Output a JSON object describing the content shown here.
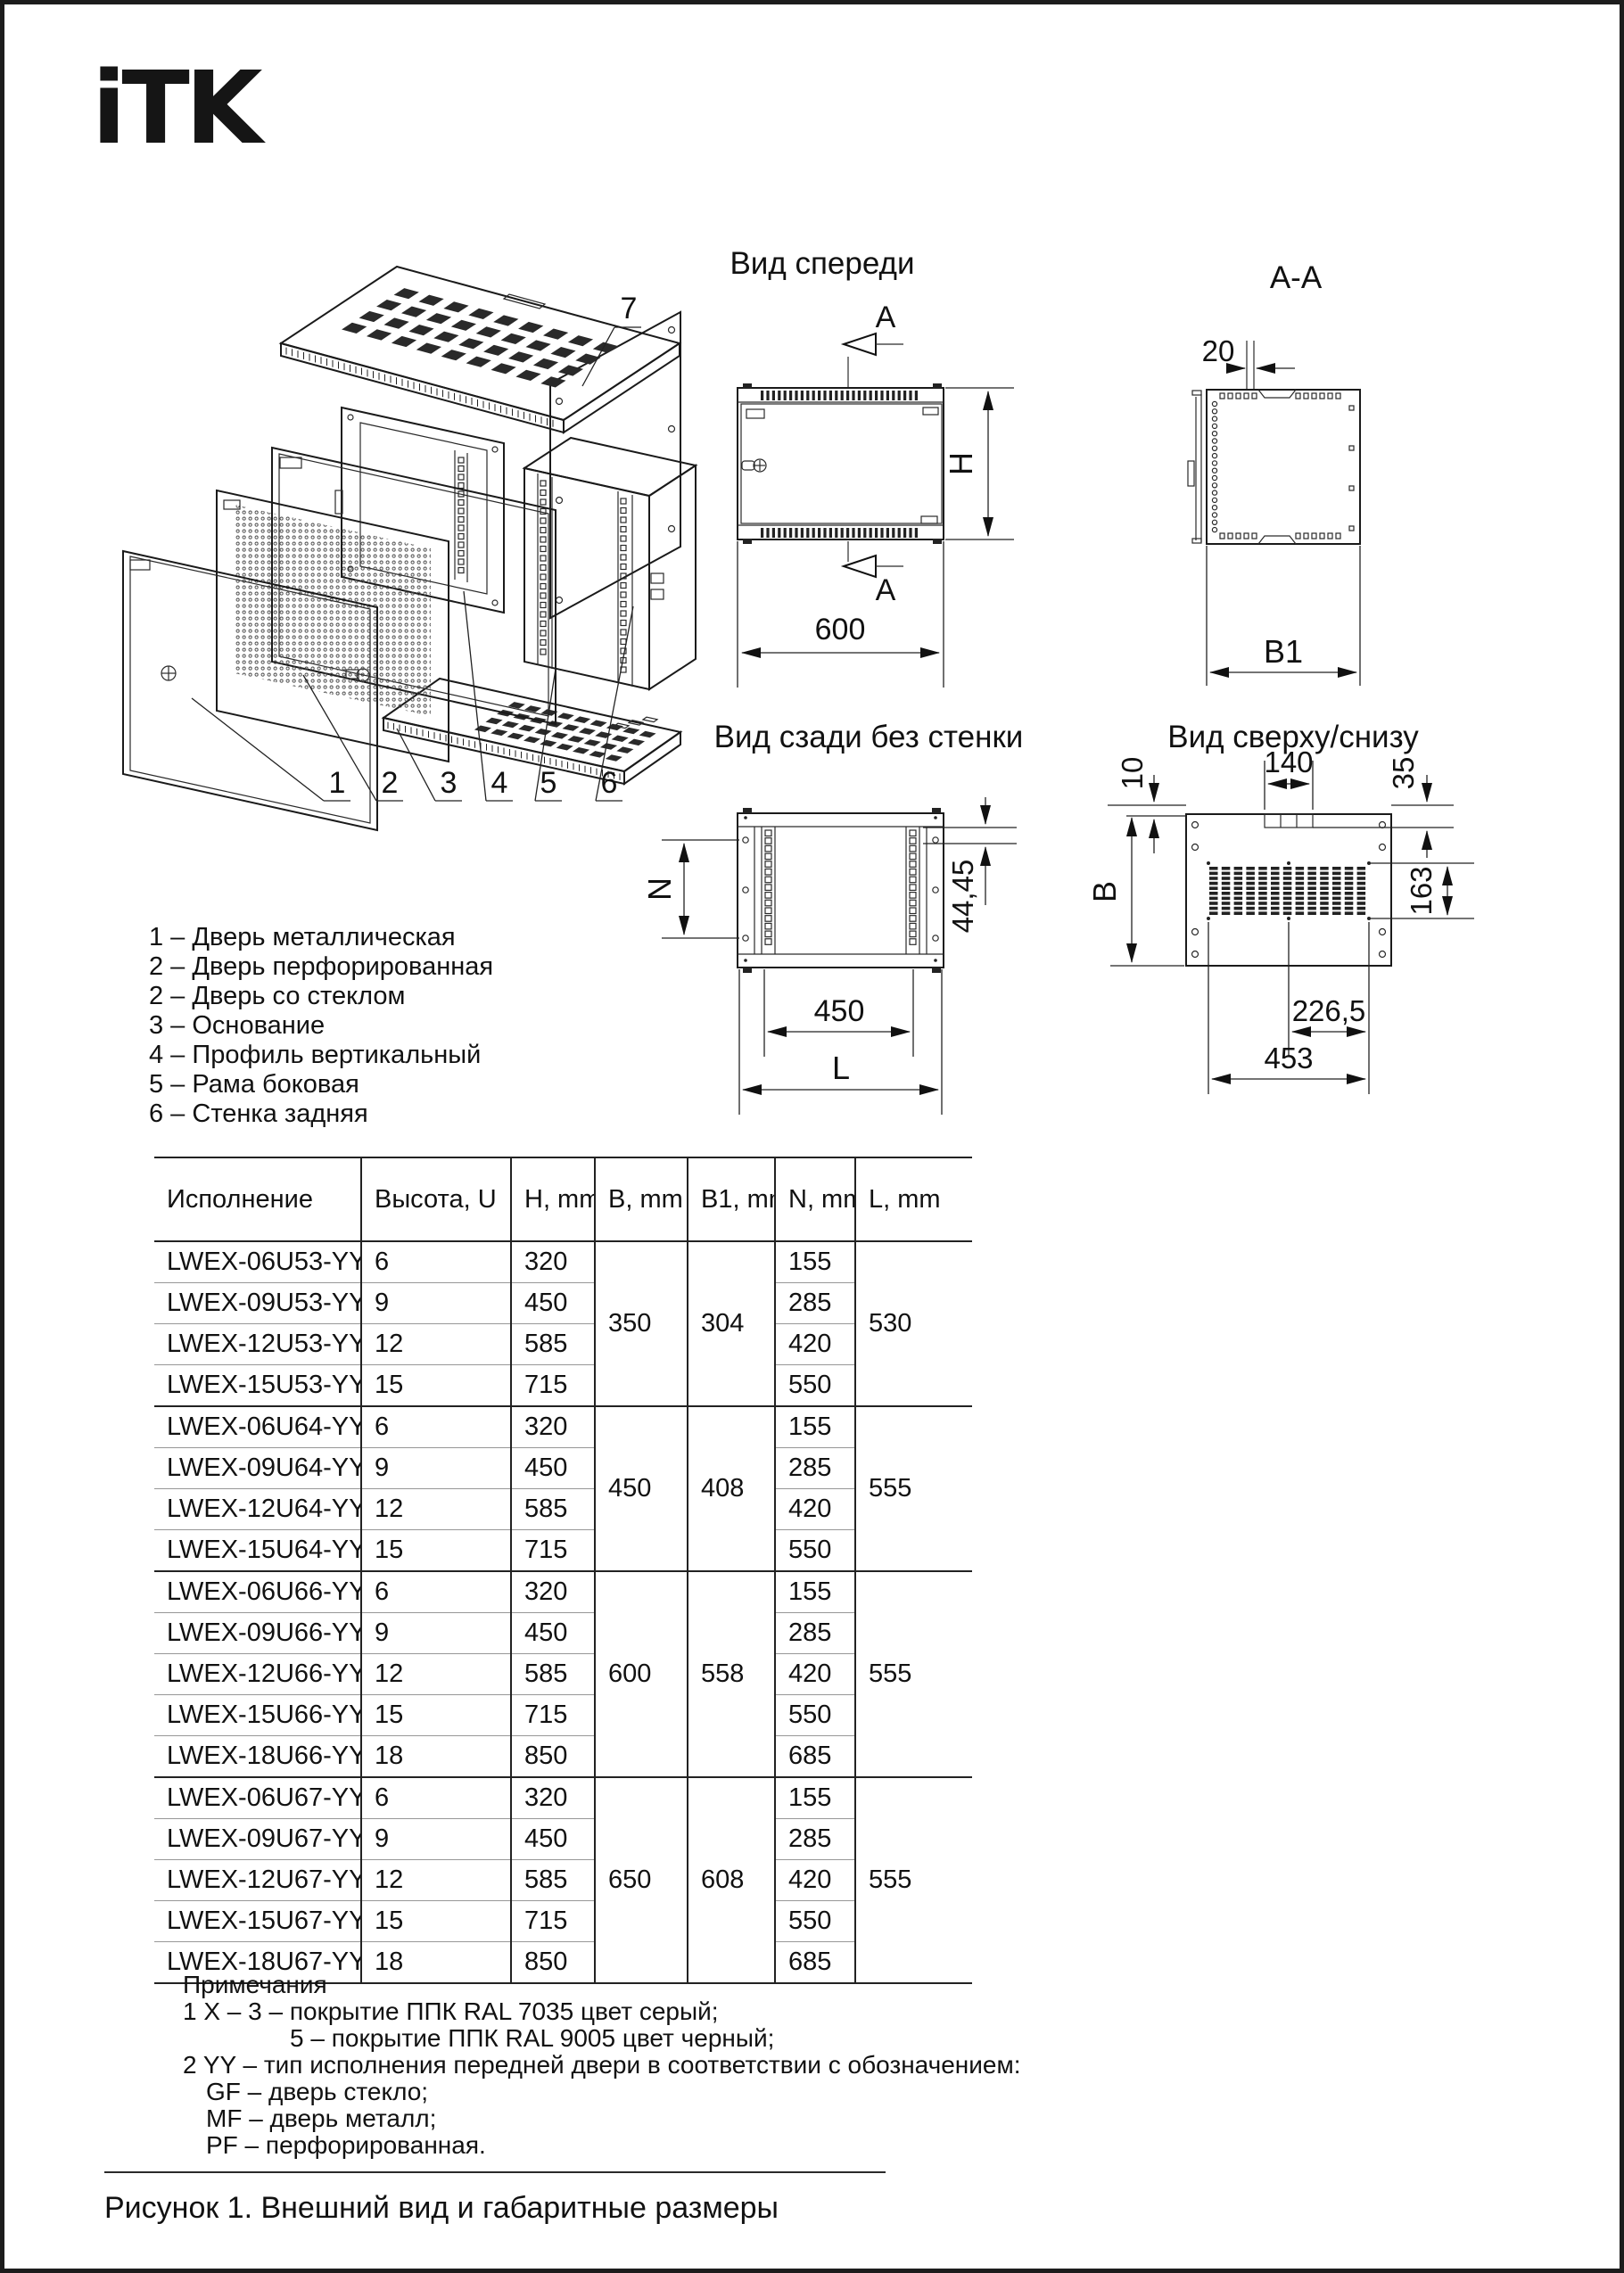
{
  "page": {
    "logo_text": "iTK",
    "caption": "Рисунок 1. Внешний вид и габаритные размеры"
  },
  "views": {
    "front": {
      "title": "Вид спереди",
      "section_label_top": "A",
      "section_label_bottom": "A",
      "dim_width": "600",
      "dim_height": "H"
    },
    "section_aa": {
      "title": "A-A",
      "dim_door_offset": "20",
      "dim_width": "B1"
    },
    "rear": {
      "title": "Вид сзади без стенки",
      "dim_height": "N",
      "dim_rail_offset": "44,45",
      "dim_rail_width": "450",
      "dim_width": "L"
    },
    "topbottom": {
      "title": "Вид сверху/снизу",
      "dim_wall_gap": "10",
      "dim_cable_entry": "140",
      "dim_depth_offset": "35",
      "dim_depth": "B",
      "dim_vent_depth": "163",
      "dim_hole_half": "226,5",
      "dim_hole_span": "453"
    }
  },
  "exploded": {
    "part_numbers": [
      "1",
      "2",
      "3",
      "4",
      "5",
      "6",
      "7"
    ]
  },
  "legend": {
    "items": [
      "1 – Дверь металлическая",
      "2 – Дверь перфорированная",
      "2 – Дверь со стеклом",
      "3 – Основание",
      "4 – Профиль вертикальный",
      "5 – Рама боковая",
      "6 – Стенка задняя"
    ]
  },
  "table": {
    "headers": [
      "Исполнение",
      "Высота, U",
      "H, mm",
      "B, mm",
      "B1, mm",
      "N, mm",
      "L, mm"
    ],
    "groups": [
      {
        "b": "350",
        "b1": "304",
        "l": "530",
        "rows": [
          {
            "model": "LWEX-06U53-YY",
            "u": "6",
            "h": "320",
            "n": "155"
          },
          {
            "model": "LWEX-09U53-YY",
            "u": "9",
            "h": "450",
            "n": "285"
          },
          {
            "model": "LWEX-12U53-YY",
            "u": "12",
            "h": "585",
            "n": "420"
          },
          {
            "model": "LWEX-15U53-YY",
            "u": "15",
            "h": "715",
            "n": "550"
          }
        ]
      },
      {
        "b": "450",
        "b1": "408",
        "l": "555",
        "rows": [
          {
            "model": "LWEX-06U64-YY",
            "u": "6",
            "h": "320",
            "n": "155"
          },
          {
            "model": "LWEX-09U64-YY",
            "u": "9",
            "h": "450",
            "n": "285"
          },
          {
            "model": "LWEX-12U64-YY",
            "u": "12",
            "h": "585",
            "n": "420"
          },
          {
            "model": "LWEX-15U64-YY",
            "u": "15",
            "h": "715",
            "n": "550"
          }
        ]
      },
      {
        "b": "600",
        "b1": "558",
        "l": "555",
        "rows": [
          {
            "model": "LWEX-06U66-YY",
            "u": "6",
            "h": "320",
            "n": "155"
          },
          {
            "model": "LWEX-09U66-YY",
            "u": "9",
            "h": "450",
            "n": "285"
          },
          {
            "model": "LWEX-12U66-YY",
            "u": "12",
            "h": "585",
            "n": "420"
          },
          {
            "model": "LWEX-15U66-YY",
            "u": "15",
            "h": "715",
            "n": "550"
          },
          {
            "model": "LWEX-18U66-YY",
            "u": "18",
            "h": "850",
            "n": "685"
          }
        ]
      },
      {
        "b": "650",
        "b1": "608",
        "l": "555",
        "rows": [
          {
            "model": "LWEX-06U67-YY",
            "u": "6",
            "h": "320",
            "n": "155"
          },
          {
            "model": "LWEX-09U67-YY",
            "u": "9",
            "h": "450",
            "n": "285"
          },
          {
            "model": "LWEX-12U67-YY",
            "u": "12",
            "h": "585",
            "n": "420"
          },
          {
            "model": "LWEX-15U67-YY",
            "u": "15",
            "h": "715",
            "n": "550"
          },
          {
            "model": "LWEX-18U67-YY",
            "u": "18",
            "h": "850",
            "n": "685"
          }
        ]
      }
    ]
  },
  "notes": {
    "title": "Примечания",
    "lines": [
      {
        "text": "1 Х – 3 – покрытие ППК RAL 7035 цвет серый;",
        "indent": 0
      },
      {
        "text": "5 – покрытие ППК RAL 9005 цвет черный;",
        "indent": 120
      },
      {
        "text": "2 YY – тип исполнения передней двери в соответствии с обозначением:",
        "indent": 0
      },
      {
        "text": "GF – дверь стекло;",
        "indent": 26
      },
      {
        "text": "MF – дверь металл;",
        "indent": 26
      },
      {
        "text": "PF – перфорированная.",
        "indent": 26
      }
    ]
  }
}
